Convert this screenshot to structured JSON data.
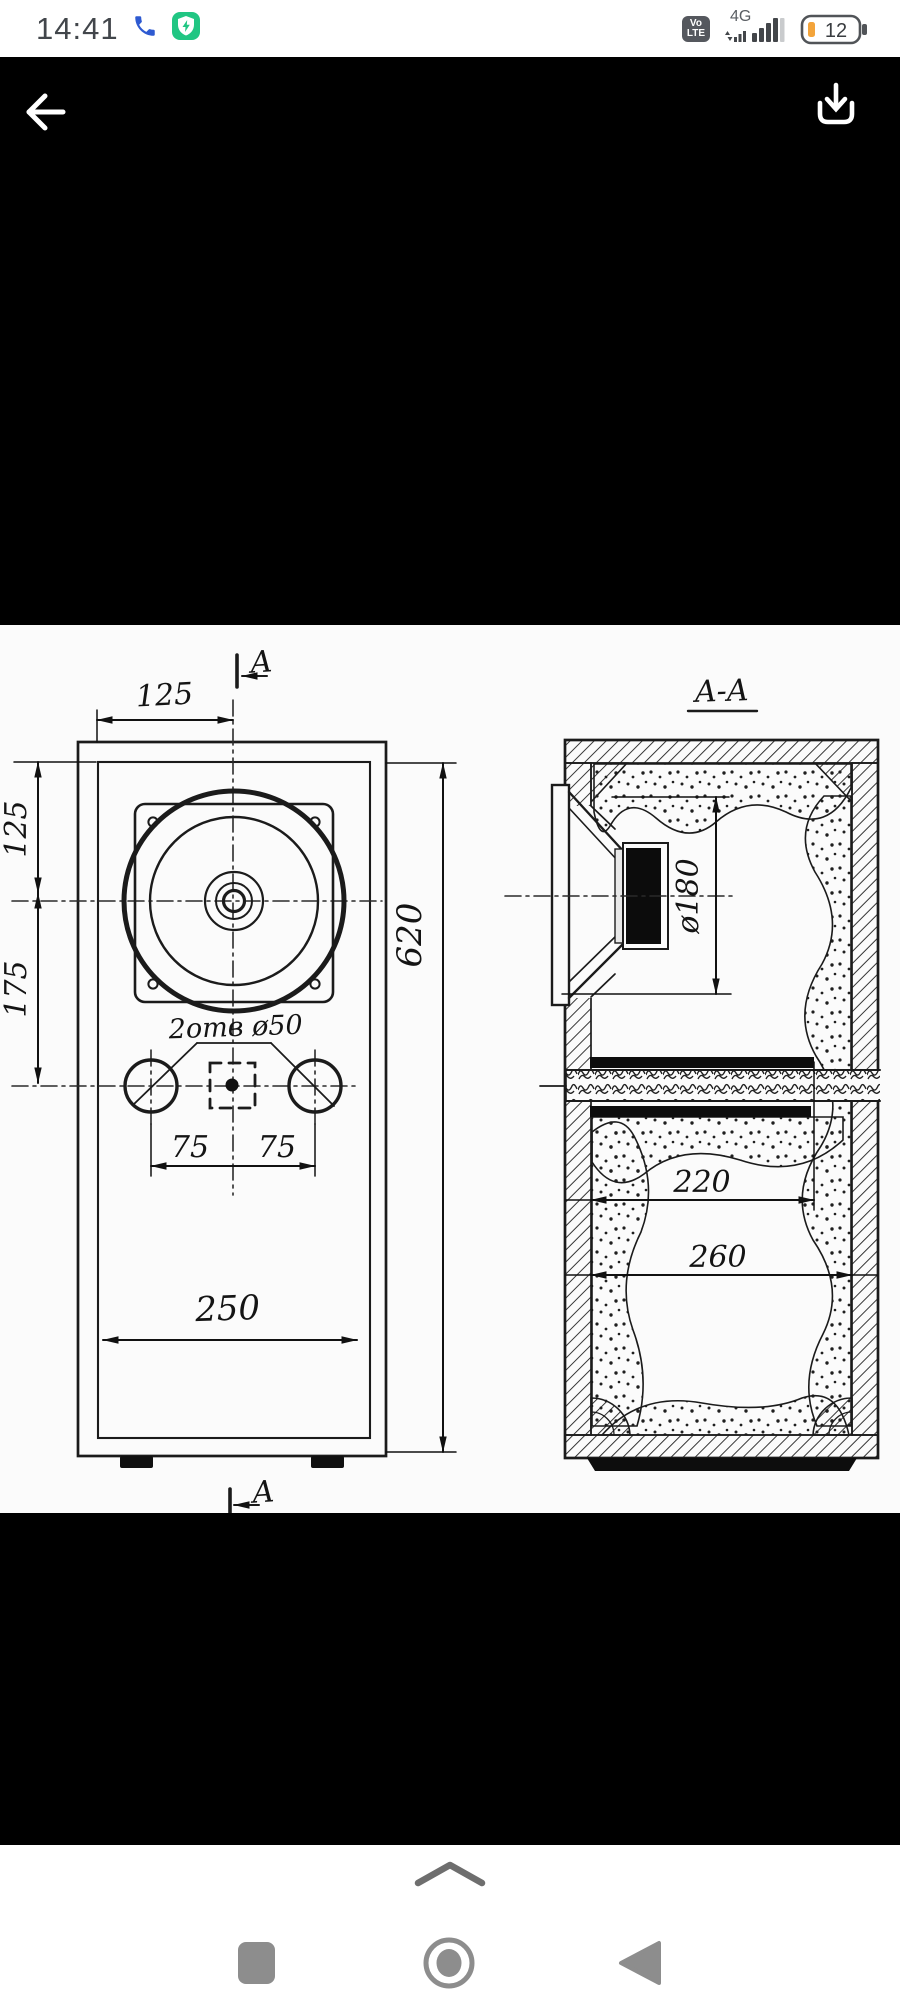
{
  "status_bar": {
    "time": "14:41",
    "volte_top": "Vo",
    "volte_bottom": "LTE",
    "network": "4G",
    "battery_level": "12"
  },
  "drawing": {
    "section_title": "A-A",
    "cut_marker": "A",
    "front_view": {
      "width_half": "125",
      "top_to_center": "125",
      "center_to_ports": "175",
      "height": "620",
      "width": "250",
      "port_left_offset": "75",
      "port_right_offset": "75",
      "ports_note": "2отв ø50"
    },
    "section_view": {
      "speaker_diameter": "ø180",
      "shelf_opening": "220",
      "inner_width": "260"
    }
  },
  "colors": {
    "status_text": "#42464b",
    "phone_icon": "#2e5ad1",
    "security_badge": "#21c683",
    "battery_accent": "#f3a43b",
    "viewer_bg": "#000000",
    "paper": "#fbfbfb",
    "ink": "#1b1b1b",
    "nav_icon": "#8d8d8d"
  }
}
